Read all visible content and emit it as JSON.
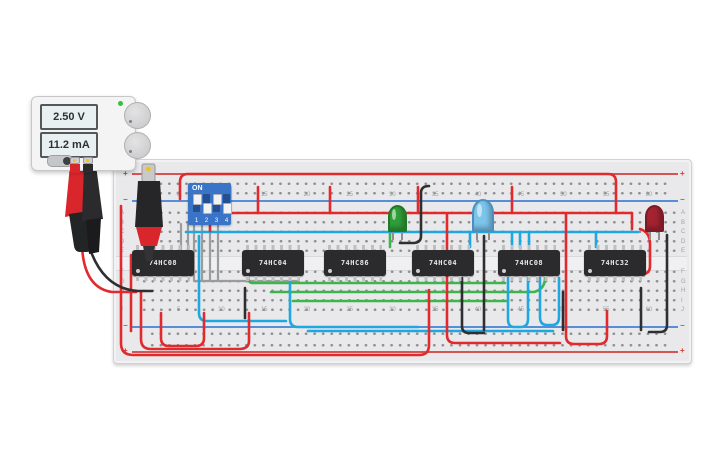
{
  "power_supply": {
    "voltage": "2.50 V",
    "current": "11.2 mA",
    "power_led_color": "#35c13a"
  },
  "breadboard": {
    "plus": "+",
    "minus": "−",
    "plus_color": "#d43a3a",
    "minus_color": "#3a7fd4",
    "column_numbers": [
      "5",
      "10",
      "15",
      "20",
      "25",
      "30",
      "35",
      "40",
      "45",
      "50",
      "55",
      "60"
    ],
    "row_letters": [
      "A",
      "B",
      "C",
      "D",
      "E",
      "F",
      "G",
      "H",
      "I",
      "J"
    ]
  },
  "dip_switch": {
    "on_label": "ON",
    "pin_labels": [
      "1",
      "2",
      "3",
      "4"
    ],
    "states": [
      true,
      false,
      true,
      false
    ]
  },
  "ics": [
    {
      "label": "74HC08",
      "x": 132
    },
    {
      "label": "74HC04",
      "x": 242
    },
    {
      "label": "74HC86",
      "x": 324
    },
    {
      "label": "74HC04",
      "x": 412
    },
    {
      "label": "74HC08",
      "x": 498
    },
    {
      "label": "74HC32",
      "x": 584
    }
  ],
  "leds": [
    {
      "name": "green-led",
      "x": 388,
      "y": 205,
      "w": 19,
      "h": 27,
      "body": "#2f9e38",
      "edge": "#1d7a26",
      "highlight": true
    },
    {
      "name": "blue-led",
      "x": 472,
      "y": 199,
      "w": 22,
      "h": 33,
      "body": "#7cc4ea",
      "edge": "#4a8fc0",
      "highlight": true
    },
    {
      "name": "red-led",
      "x": 645,
      "y": 205,
      "w": 19,
      "h": 27,
      "body": "#a32331",
      "edge": "#7e1a25",
      "highlight": false
    }
  ],
  "wire_colors": {
    "red": "#e02a2d",
    "blue": "#1ea7e0",
    "green": "#3cb54a",
    "black": "#2f2f31",
    "gray": "#9a9c9e"
  },
  "wires": [
    {
      "c": "gray",
      "d": "M194 224 L194 281"
    },
    {
      "c": "gray",
      "d": "M202 224 L202 281"
    },
    {
      "c": "gray",
      "d": "M210 224 L210 281"
    },
    {
      "c": "gray",
      "d": "M218 224 L218 281"
    },
    {
      "c": "gray",
      "d": "M196 281 L299 281"
    },
    {
      "c": "gray",
      "d": "M181 224 L181 257"
    },
    {
      "c": "gray",
      "d": "M188 224 L188 257"
    },
    {
      "c": "green",
      "d": "M253 283 L505 283"
    },
    {
      "c": "green",
      "d": "M271 292 L500 292"
    },
    {
      "c": "green",
      "d": "M293 301 L508 301"
    },
    {
      "c": "green",
      "d": "M390 233 L390 247"
    },
    {
      "c": "green",
      "d": "M545 278 Q545 289 534 292 L500 292"
    },
    {
      "c": "green",
      "d": "M253 283 Q248 283 248 277"
    },
    {
      "c": "blue",
      "d": "M186 232 L638 232"
    },
    {
      "c": "blue",
      "d": "M199 236 L199 313 Q199 321 207 321 L286 321"
    },
    {
      "c": "blue",
      "d": "M290 277 L290 319 Q290 327 298 327 L418 327"
    },
    {
      "c": "blue",
      "d": "M508 278 L508 319 Q508 327 514 327 L521 327 Q528 327 528 319 L528 278"
    },
    {
      "c": "blue",
      "d": "M540 278 L540 317 Q540 325 547 325 L552 325 Q559 325 559 317 L559 278"
    },
    {
      "c": "blue",
      "d": "M553 331 L308 331"
    },
    {
      "c": "blue",
      "d": "M512 232 L512 247"
    },
    {
      "c": "blue",
      "d": "M520 232 L520 247"
    },
    {
      "c": "blue",
      "d": "M529 232 L529 247"
    },
    {
      "c": "blue",
      "d": "M596 232 L596 247"
    },
    {
      "c": "blue",
      "d": "M470 232 L470 247"
    },
    {
      "c": "red",
      "d": "M180 199 L180 182 Q180 174 188 174 L608 174 Q616 174 616 182 L616 213"
    },
    {
      "c": "red",
      "d": "M206 213 L631 213"
    },
    {
      "c": "red",
      "d": "M258 187 L258 213"
    },
    {
      "c": "red",
      "d": "M330 187 L330 213"
    },
    {
      "c": "red",
      "d": "M418 187 L418 213"
    },
    {
      "c": "red",
      "d": "M512 187 L512 213"
    },
    {
      "c": "red",
      "d": "M566 214 L566 336 Q566 344 574 344 L599 344 Q607 344 607 336 L607 311"
    },
    {
      "c": "red",
      "d": "M447 214 L447 335 Q447 343 455 343 L560 343"
    },
    {
      "c": "red",
      "d": "M121 206 L121 343 Q121 355 133 355 L419 355 Q429 355 429 345 L429 290"
    },
    {
      "c": "red",
      "d": "M141 291 L141 339 Q141 349 151 349 L239 349 Q249 349 249 341 L249 313"
    },
    {
      "c": "red",
      "d": "M161 313 L161 338 Q161 346 169 346 L196 346 Q204 346 204 338 L204 313"
    },
    {
      "c": "red",
      "d": "M131 255 L131 331"
    },
    {
      "c": "red",
      "d": "M82 246 Q84 288 112 292 L136 292"
    },
    {
      "c": "red",
      "d": "M76 170 L76 246"
    },
    {
      "c": "red",
      "d": "M640 229 Q650 232 650 244 L650 266 Q650 274 642 274 L629 274"
    },
    {
      "c": "red",
      "d": "M230 187 L230 213"
    },
    {
      "c": "red",
      "d": "M210 218 L210 231"
    },
    {
      "c": "red",
      "d": "M632 213 L632 229"
    },
    {
      "c": "black",
      "d": "M429 186 Q421 186 421 193 L421 236 Q421 243 413 243 L400 243"
    },
    {
      "c": "black",
      "d": "M245 288 L245 318"
    },
    {
      "c": "black",
      "d": "M462 278 L462 326 Q462 333 469 333 L484 333"
    },
    {
      "c": "black",
      "d": "M563 292 L563 330"
    },
    {
      "c": "black",
      "d": "M641 288 L641 330"
    },
    {
      "c": "black",
      "d": "M667 235 L667 325 Q667 332 660 332 L649 332"
    },
    {
      "c": "black",
      "d": "M90 249 Q104 289 138 291 L152 291"
    },
    {
      "c": "black",
      "d": "M484 236 L484 330"
    }
  ]
}
